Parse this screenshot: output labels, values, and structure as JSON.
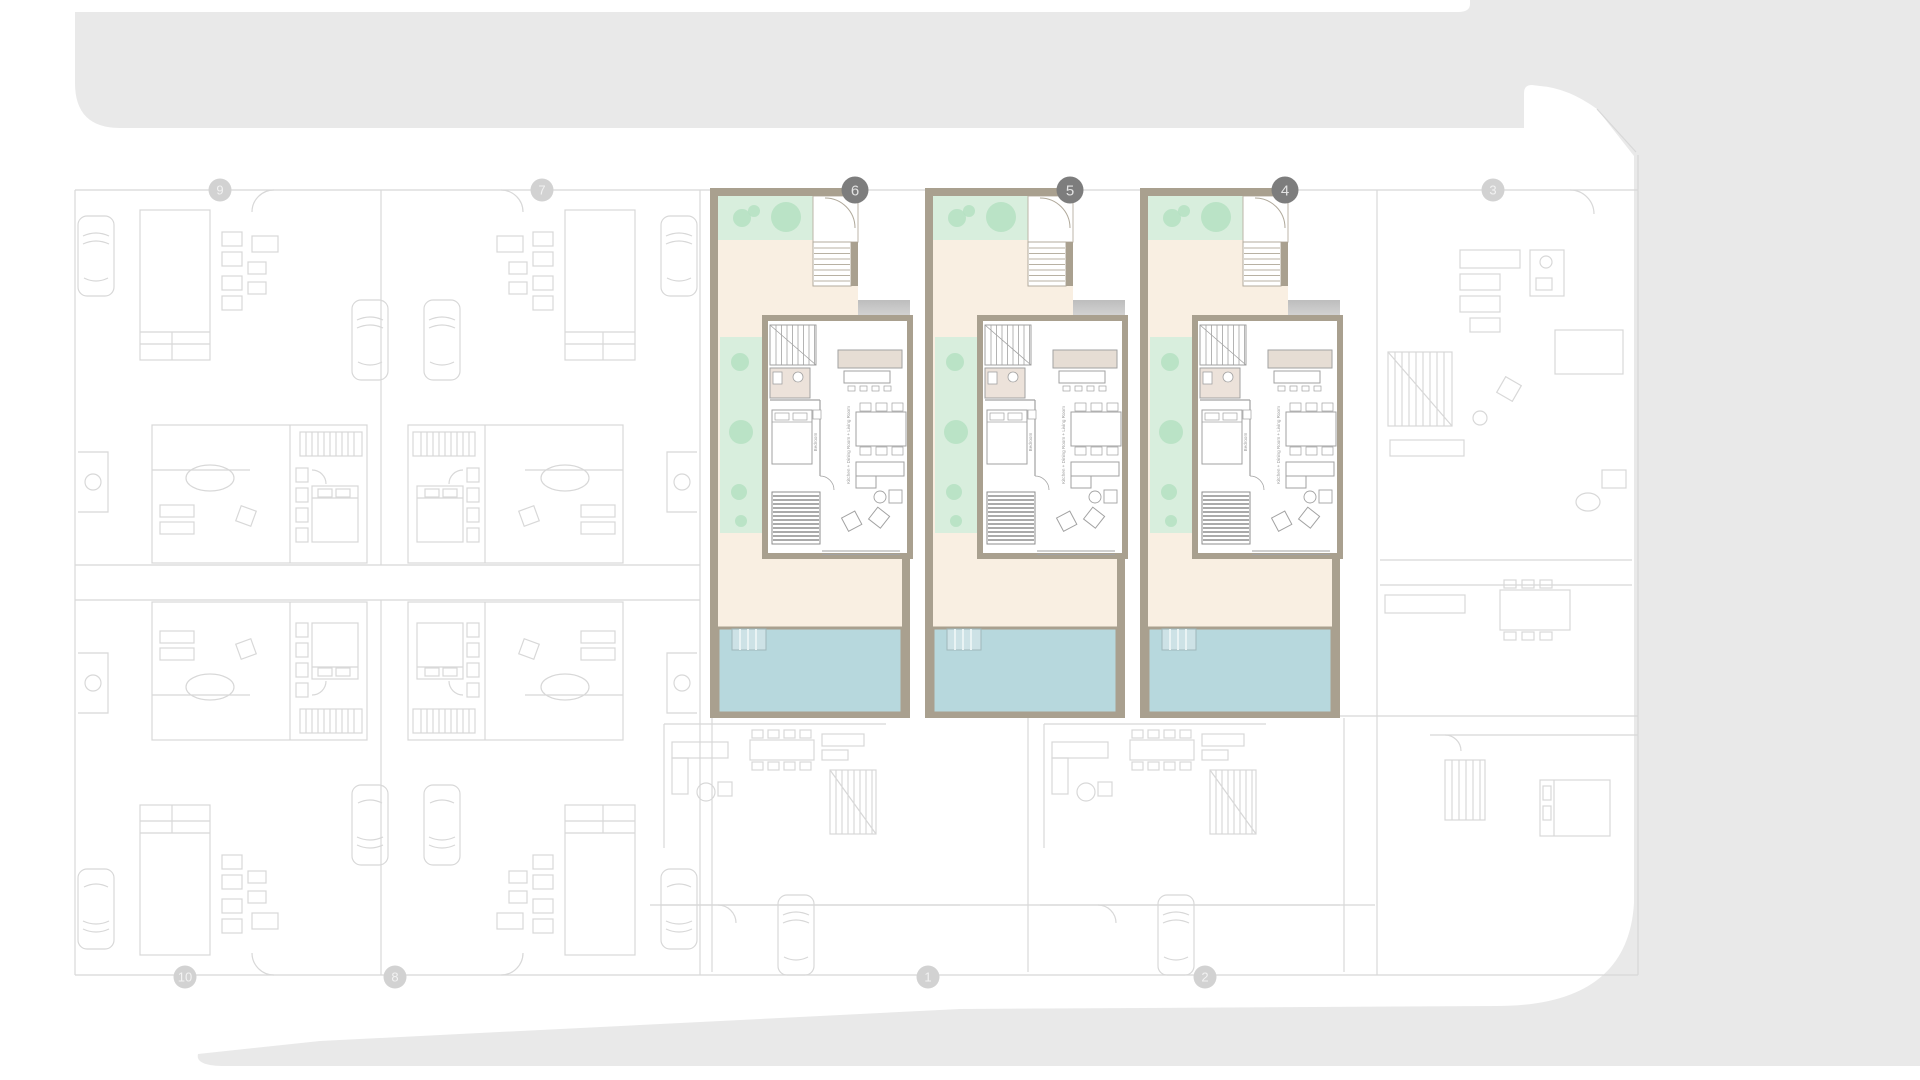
{
  "page": {
    "kind": "residential-site-floor-plan",
    "background_color": "#ffffff",
    "street_color": "#e9e9e9"
  },
  "plan": {
    "highlighted_units": [
      {
        "number": "6",
        "x": 710
      },
      {
        "number": "5",
        "x": 925
      },
      {
        "number": "4",
        "x": 1140
      }
    ],
    "unit_labels": {
      "living": "Kitchen + Dining Room + Living Room",
      "bedroom": "Bedroom"
    },
    "markers_top": [
      {
        "label": "9",
        "x": 220,
        "y": 190,
        "state": "faded"
      },
      {
        "label": "7",
        "x": 542,
        "y": 190,
        "state": "faded"
      },
      {
        "label": "6",
        "x": 855,
        "y": 190,
        "state": "highlighted"
      },
      {
        "label": "5",
        "x": 1070,
        "y": 190,
        "state": "highlighted"
      },
      {
        "label": "4",
        "x": 1285,
        "y": 190,
        "state": "highlighted"
      },
      {
        "label": "3",
        "x": 1493,
        "y": 190,
        "state": "faded"
      }
    ],
    "markers_bottom": [
      {
        "label": "10",
        "x": 185,
        "y": 977,
        "state": "faded"
      },
      {
        "label": "8",
        "x": 395,
        "y": 977,
        "state": "faded"
      },
      {
        "label": "1",
        "x": 928,
        "y": 977,
        "state": "faded"
      },
      {
        "label": "2",
        "x": 1205,
        "y": 977,
        "state": "faded"
      }
    ],
    "colors": {
      "wall": "#a9a08f",
      "cream": "#f9efe2",
      "garden": "#d8eedd",
      "tree": "#b5e1c2",
      "pool": "#b7d8dd",
      "pool_steps": "#cde2e6",
      "bath": "#ece2da",
      "counter": "#e6ddd4",
      "marker_highlight": "#7d7d7d",
      "marker_highlight_text": "#e3e3e3",
      "marker_faded": "#d2d2d2",
      "marker_faded_text": "#f2f2f2",
      "faded_line": "#d8d8d8",
      "interior_line": "#a2a2a2"
    }
  }
}
